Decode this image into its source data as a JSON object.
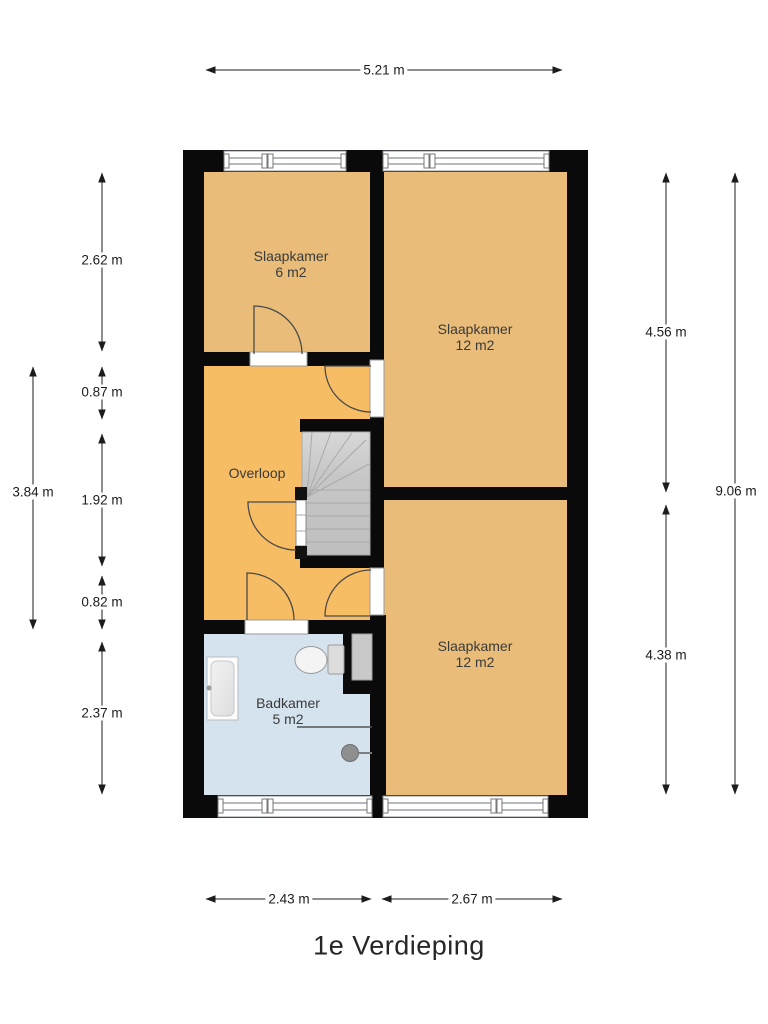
{
  "title": "1e Verdieping",
  "rooms": {
    "slaapkamer_tl": {
      "name": "Slaapkamer",
      "area": "6 m2"
    },
    "slaapkamer_tr": {
      "name": "Slaapkamer",
      "area": "12 m2"
    },
    "overloop": {
      "name": "Overloop"
    },
    "slaapkamer_br": {
      "name": "Slaapkamer",
      "area": "12 m2"
    },
    "badkamer": {
      "name": "Badkamer",
      "area": "5 m2"
    }
  },
  "dimensions": {
    "top_width": "5.21 m",
    "left_segments": [
      "2.62 m",
      "0.87 m",
      "1.92 m",
      "0.82 m",
      "2.37 m"
    ],
    "left_total": "3.84 m",
    "right_segments": [
      "4.56 m",
      "4.38 m"
    ],
    "right_total": "9.06 m",
    "bottom_segments": [
      "2.43 m",
      "2.67 m"
    ]
  },
  "colors": {
    "bedroom_floor": "#e9bd79",
    "overloop_floor": "#f7bd64",
    "bathroom_floor": "#d5e3ef",
    "wall": "#0a0a0a",
    "stairs_fill": "#c7c7c7",
    "window_frame": "#8a9096",
    "door_stroke": "#4a4a4a",
    "dimension_line": "#1c1c1c",
    "label_text": "#3a3a3a",
    "title_text": "#262626"
  }
}
